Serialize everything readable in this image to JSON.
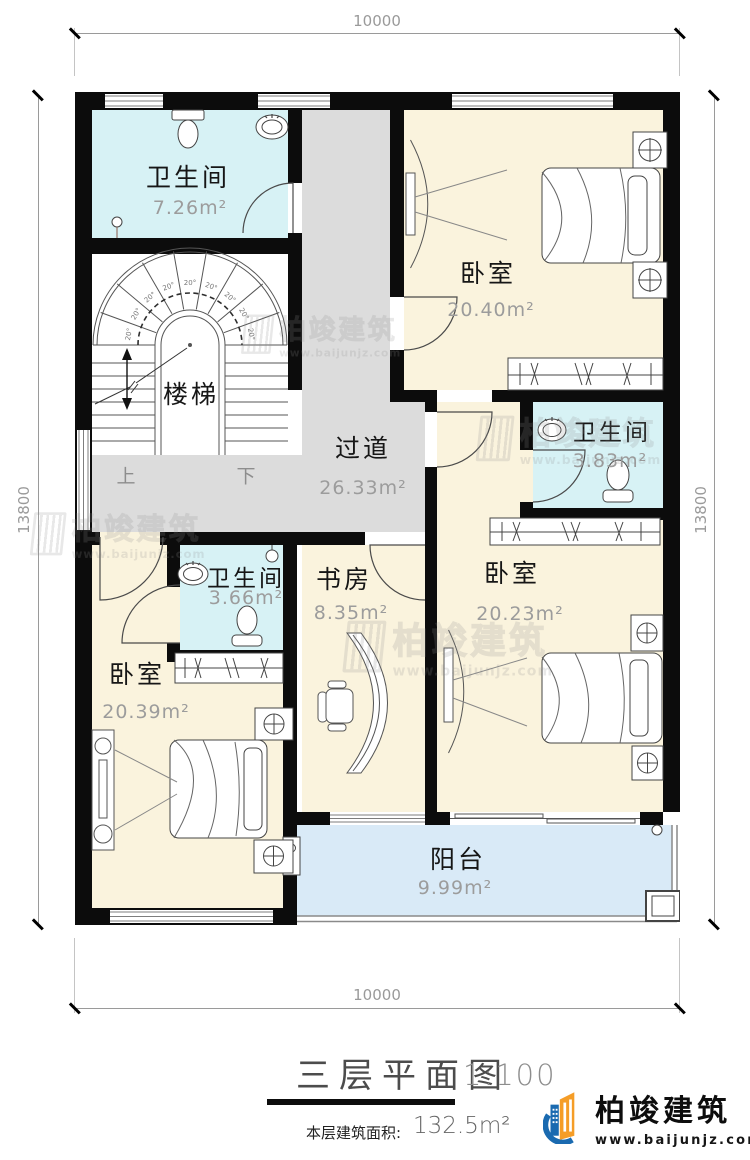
{
  "plan": {
    "dimensions": {
      "top": "10000",
      "bottom": "10000",
      "left": "13800",
      "right": "13800"
    },
    "rooms": {
      "bath_top": {
        "name": "卫生间",
        "area": "7.26m²"
      },
      "bedroom_top": {
        "name": "卧室",
        "area": "20.40m²"
      },
      "stairs": {
        "name": "楼梯",
        "up": "上",
        "down": "下",
        "step_angle": "20°"
      },
      "hallway": {
        "name": "过道",
        "area": "26.33m²"
      },
      "bath_mid": {
        "name": "卫生间",
        "area": "3.83m²"
      },
      "bedroom_right": {
        "name": "卧室",
        "area": "20.23m²"
      },
      "study": {
        "name": "书房",
        "area": "8.35m²"
      },
      "bath_low": {
        "name": "卫生间",
        "area": "3.66m²"
      },
      "bedroom_low": {
        "name": "卧室",
        "area": "20.39m²"
      },
      "balcony": {
        "name": "阳台",
        "area": "9.99m²"
      }
    },
    "colors": {
      "bath": "#d7f2f5",
      "bedroom": "#faf3dd",
      "hallway": "#dcdcdc",
      "balcony": "#d9eaf7",
      "wall": "#0c0c0c"
    }
  },
  "watermark": {
    "name": "柏竣建筑",
    "url": "www.baijunjz.com"
  },
  "title": {
    "name": "三层平面图",
    "scale": "1:100",
    "floor_area_label": "本层建筑面积:",
    "floor_area_value": "132.5m²"
  },
  "brand": {
    "name": "柏竣建筑",
    "url": "www.baijunjz.com",
    "blue": "#1a6ab0",
    "orange": "#f59d27"
  }
}
